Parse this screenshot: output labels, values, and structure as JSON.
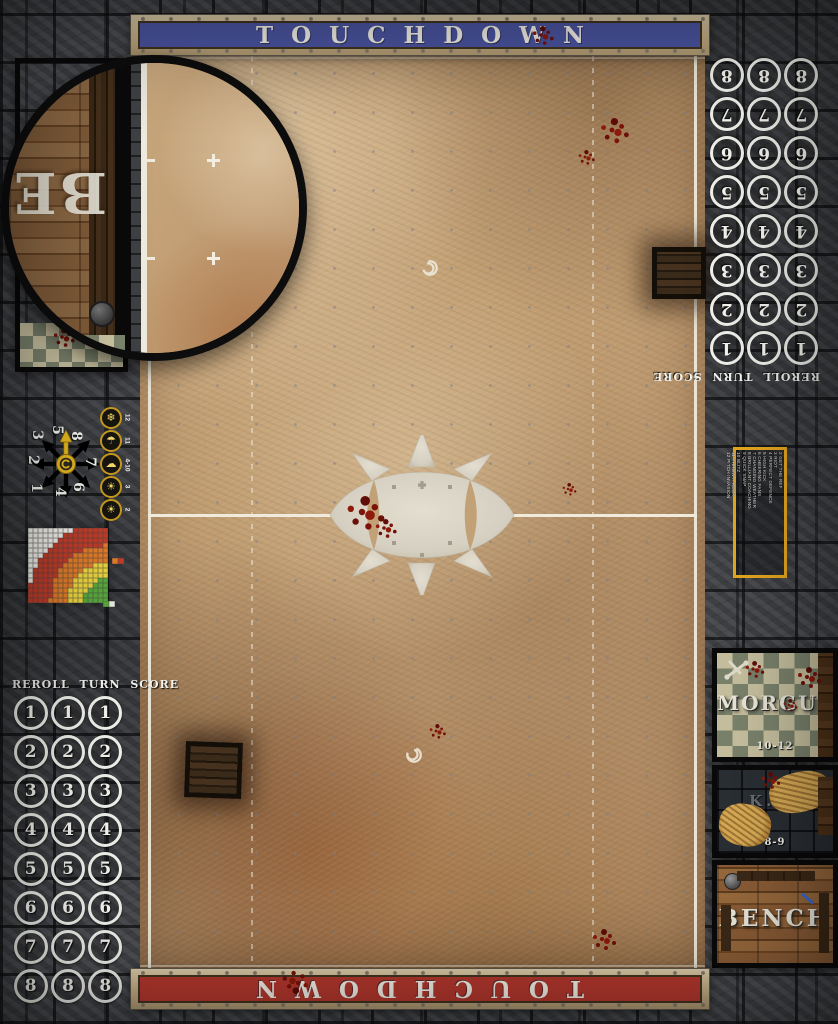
{
  "app": {
    "title": "Blood Bowl dirt pitch game mat"
  },
  "banners": {
    "top_label": "TOUCHDOWN",
    "top_color": "#4b55a2",
    "bottom_label": "TOUCHDOWN",
    "bottom_color": "#b5382e"
  },
  "turn_tracks": {
    "header": "REROLL TURN SCORE",
    "columns": 3,
    "numbers": [
      "1",
      "2",
      "3",
      "4",
      "5",
      "6",
      "7",
      "8"
    ]
  },
  "scatter_wheel": {
    "positions": [
      {
        "n": "3",
        "x": -29,
        "y": -29
      },
      {
        "n": "5",
        "x": -9,
        "y": -34
      },
      {
        "n": "8",
        "x": 10,
        "y": -28
      },
      {
        "n": "2",
        "x": -33,
        "y": -4
      },
      {
        "n": "7",
        "x": 24,
        "y": -2
      },
      {
        "n": "1",
        "x": -30,
        "y": 24
      },
      {
        "n": "4",
        "x": -6,
        "y": 28
      },
      {
        "n": "6",
        "x": 12,
        "y": 23
      }
    ]
  },
  "weather_track": {
    "entries": [
      {
        "roll": "12",
        "icon": "blizzard-icon",
        "glyph": "❄"
      },
      {
        "roll": "11",
        "icon": "pouring-rain-icon",
        "glyph": "☂"
      },
      {
        "roll": "4-10",
        "icon": "perfect-weather-icon",
        "glyph": "☁"
      },
      {
        "roll": "3",
        "icon": "very-sunny-icon",
        "glyph": "☀"
      },
      {
        "roll": "2",
        "icon": "sweltering-heat-icon",
        "glyph": "☀"
      }
    ]
  },
  "kickoff_table": {
    "entries": [
      "2 GET THE REF",
      "3 RIOT",
      "4 PERFECT DEFENCE",
      "5 HIGH KICK",
      "6 CHEERING FANS",
      "7 CHANGING WEATHER",
      "8 BRILLIANT COACHING",
      "9 QUICK SNAP",
      "10 BLITZ",
      "11 THROW A ROCK",
      "12 PITCH INVASION"
    ],
    "border_color": "#e7a81f"
  },
  "dugout": {
    "morgue_label": "MORGUE",
    "morgue_range": "10-12",
    "ko_label": "K.O.",
    "ko_range": "8-9",
    "bench_label": "BENCH",
    "magnifier_letters": "BE"
  },
  "chart_data": {
    "type": "heatmap",
    "title": "Passing range ruler",
    "grid": {
      "cols": 16,
      "rows": 15,
      "origin": "bottom-right"
    },
    "bands": [
      {
        "name": "quick_pass",
        "max_distance": 4.2,
        "color": "#58a83c"
      },
      {
        "name": "short_pass",
        "max_distance": 7.6,
        "color": "#e8d23c"
      },
      {
        "name": "long_pass",
        "max_distance": 11.0,
        "color": "#e07b28"
      },
      {
        "name": "long_bomb",
        "max_distance": 15.3,
        "color": "#c23b28"
      },
      {
        "name": "out_of_range",
        "max_distance": 99,
        "color": "#f1efe8"
      }
    ],
    "legend_pairs": [
      [
        "#e07b28",
        "#c23b28"
      ],
      [
        "#58a83c",
        "#e8e8df"
      ]
    ]
  }
}
